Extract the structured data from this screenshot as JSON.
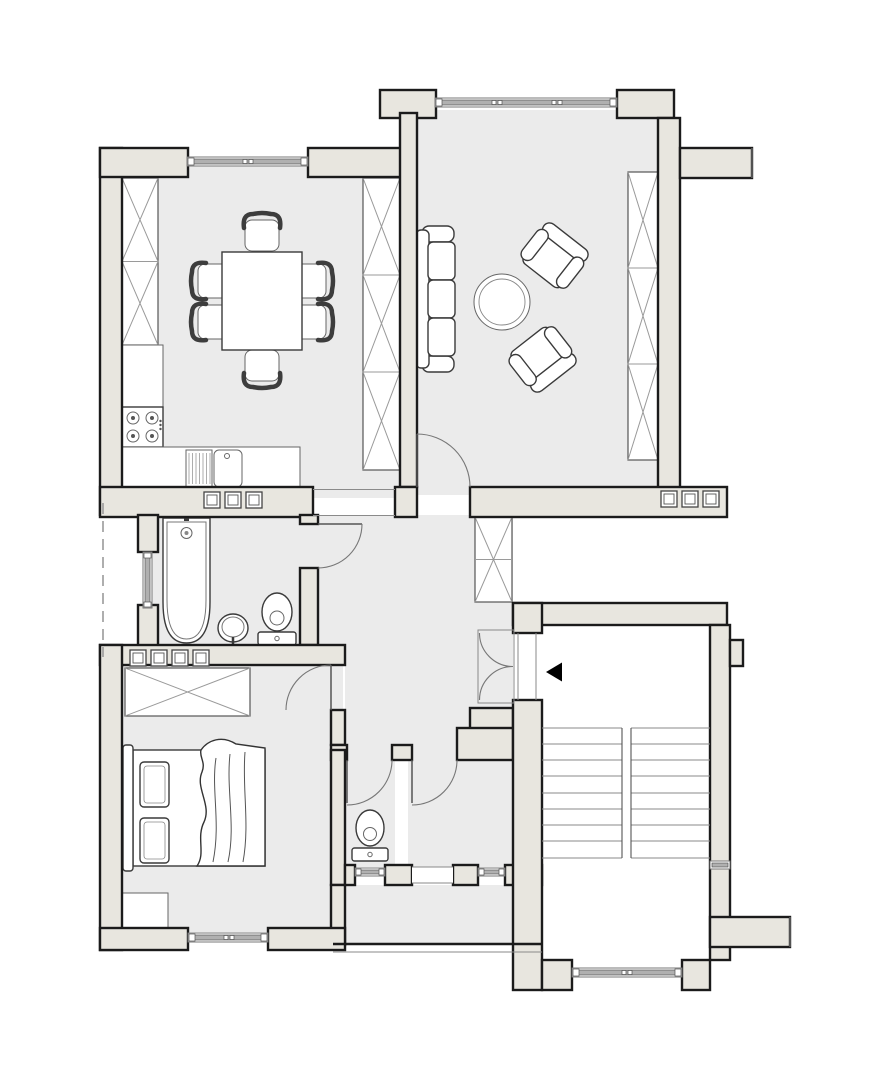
{
  "meta": {
    "kind": "architectural-floor-plan",
    "description": "Black-line apartment floor plan with beige walls and grey room floors; no text labels",
    "image_width": 892,
    "image_height": 1080
  },
  "colors": {
    "bg": "#ffffff",
    "wall": "#e8e6df",
    "wallstroke": "#1b1b1b",
    "floor": "#ebebeb",
    "fix": "#3a3a3a",
    "winbar": "#b0b0b0",
    "arrow": "#000000"
  },
  "rooms": [
    {
      "id": "kitchen-dining",
      "contents": [
        "dining-table",
        "chair x6",
        "wardrobe-2-cell",
        "wardrobe-3-cell",
        "tall-cabinet",
        "stove-4-burner",
        "counter-with-sink-and-drainboard"
      ]
    },
    {
      "id": "living-room",
      "contents": [
        "sofa-3-seat",
        "armchair x2",
        "round-coffee-table",
        "wardrobe-3-cell"
      ]
    },
    {
      "id": "bathroom",
      "contents": [
        "bathtub",
        "washbasin",
        "toilet"
      ]
    },
    {
      "id": "hallway",
      "contents": [
        "wardrobe-1-cell",
        "entrance-double-door"
      ]
    },
    {
      "id": "bedroom",
      "contents": [
        "double-bed-with-blanket",
        "pillow x2",
        "wardrobe-wide",
        "cabinet"
      ]
    },
    {
      "id": "wc",
      "contents": [
        "toilet"
      ]
    },
    {
      "id": "storage",
      "contents": []
    },
    {
      "id": "stairwell",
      "contents": [
        "stair-flight x2",
        "landing x2",
        "entrance-arrow-left"
      ]
    },
    {
      "id": "common-corridor",
      "contents": []
    },
    {
      "id": "light-shaft",
      "contents": [
        "dashed-facade-line",
        "shaft-window"
      ]
    }
  ],
  "openings": {
    "windows": [
      "dining-top",
      "living-top",
      "bathroom-shaft",
      "bedroom-bottom",
      "wc-bottom",
      "storage-bottom",
      "stair-bottom",
      "stair-right-small"
    ],
    "doors": [
      "living-to-hall",
      "bathroom-to-hall",
      "bedroom-to-hall",
      "wc",
      "storage",
      "entrance-double"
    ],
    "passages": [
      "dining-to-hall-open"
    ]
  },
  "stairs": {
    "flights": 2,
    "step_lines": 9,
    "direction_arrow": "left"
  },
  "vent_blocks": {
    "kitchen_belt": 3,
    "bathroom_belt": 4,
    "living_belt": 3
  }
}
